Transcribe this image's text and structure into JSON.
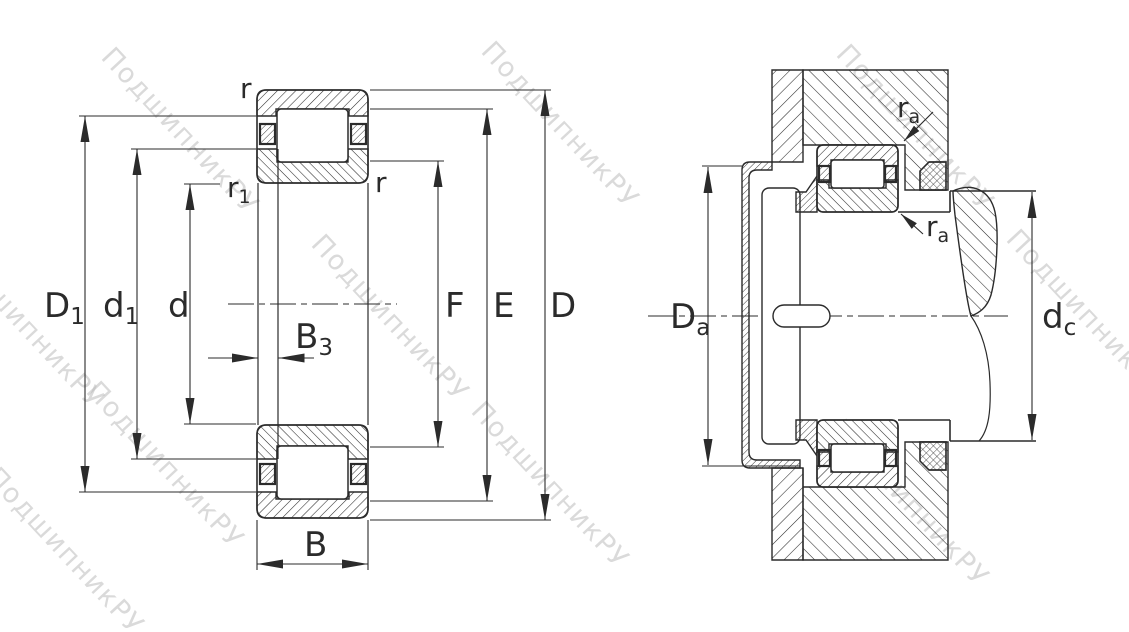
{
  "drawing": {
    "type": "bearing-technical-drawing",
    "views": {
      "section_view": {
        "dimension_labels": {
          "D1": {
            "main": "D",
            "sub": "1"
          },
          "d1": {
            "main": "d",
            "sub": "1"
          },
          "d": {
            "main": "d"
          },
          "B3": {
            "main": "B",
            "sub": "3"
          },
          "B": {
            "main": "B"
          },
          "F": {
            "main": "F"
          },
          "E": {
            "main": "E"
          },
          "D": {
            "main": "D"
          },
          "r_top": {
            "main": "r"
          },
          "r_inner": {
            "main": "r"
          },
          "r1": {
            "main": "r",
            "sub": "1"
          }
        }
      },
      "mounting_view": {
        "dimension_labels": {
          "Da": {
            "main": "D",
            "sub": "a"
          },
          "dc": {
            "main": "d",
            "sub": "c"
          },
          "ra_upper": {
            "main": "r",
            "sub": "a"
          },
          "ra_lower": {
            "main": "r",
            "sub": "a"
          }
        }
      }
    }
  },
  "watermark": {
    "text": "ПодшипникРУ"
  },
  "colors": {
    "line": "#2b2b2b",
    "background": "#ffffff",
    "watermark": "#bcbcbc"
  }
}
